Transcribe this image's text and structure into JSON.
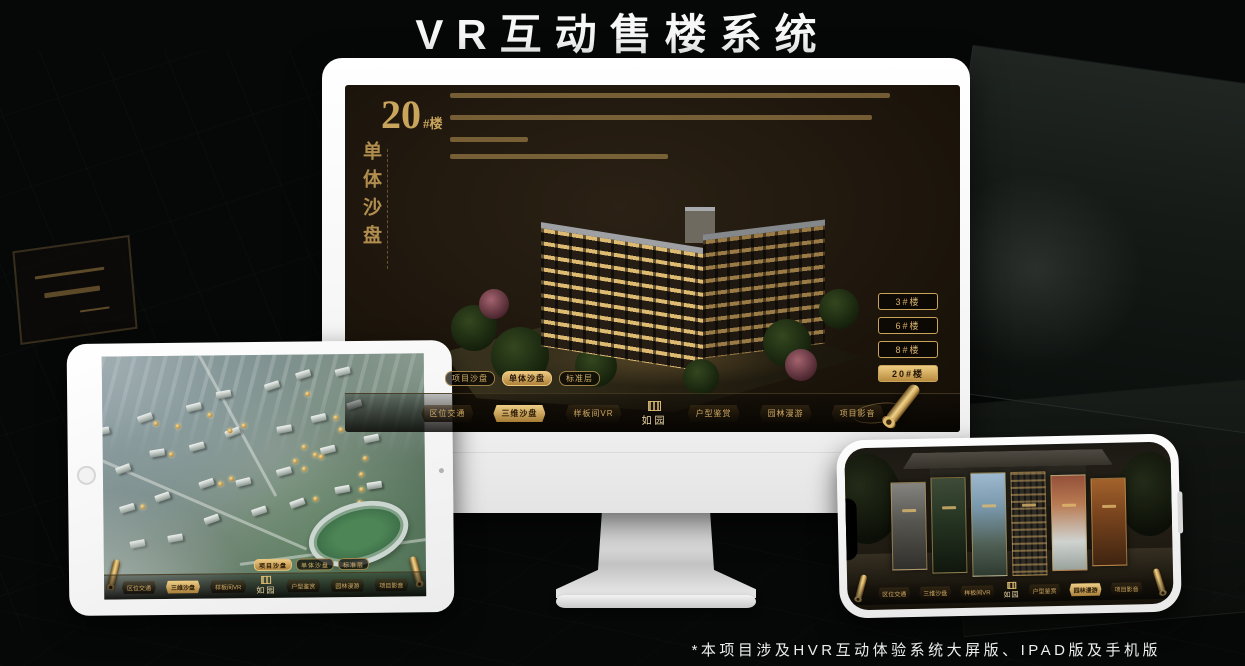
{
  "page": {
    "title": "VR互动售楼系统",
    "footnote": "*本项目涉及HVR互动体验系统大屏版、IPAD版及手机版"
  },
  "colors": {
    "gold": "#c9a45c",
    "screen_background": "#191209",
    "device_shell": "#ffffff"
  },
  "logo": {
    "text": "如园"
  },
  "nav_items": [
    {
      "label": "区位交通"
    },
    {
      "label": "三维沙盘"
    },
    {
      "label": "样板间VR"
    },
    {
      "label": "户型鉴赏"
    },
    {
      "label": "园林漫游"
    },
    {
      "label": "项目影音"
    }
  ],
  "monitor": {
    "heading_number": "20",
    "heading_unit": "#楼",
    "heading_subtitle": "单体沙盘",
    "mode_tabs": [
      {
        "label": "项目沙盘",
        "active": false
      },
      {
        "label": "单体沙盘",
        "active": true
      },
      {
        "label": "标准层",
        "active": false
      }
    ],
    "building_buttons": [
      {
        "label": "3#楼",
        "active": false
      },
      {
        "label": "6#楼",
        "active": false
      },
      {
        "label": "8#楼",
        "active": false
      },
      {
        "label": "20#楼",
        "active": true
      }
    ],
    "active_nav_index": 1
  },
  "tablet": {
    "mode_tabs": [
      {
        "label": "项目沙盘",
        "active": true
      },
      {
        "label": "单体沙盘",
        "active": false
      },
      {
        "label": "标准层",
        "active": false
      }
    ],
    "active_nav_index": 1
  },
  "phone": {
    "active_nav_index": 4,
    "gallery_panel_count": 6
  }
}
